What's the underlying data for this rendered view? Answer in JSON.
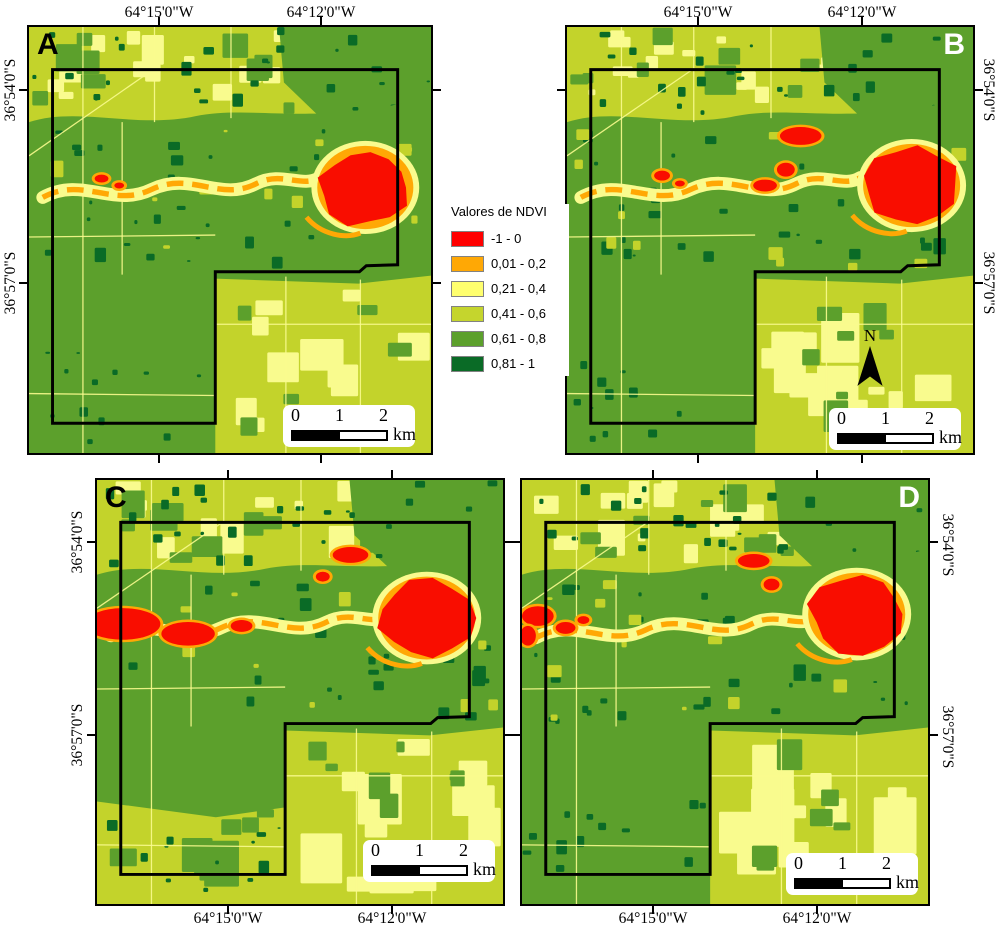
{
  "figure": {
    "type": "ndvi-classified-map-figure",
    "background": "#FFFFFF"
  },
  "legend": {
    "title": "Valores de NDVI",
    "classes": [
      {
        "label": "-1 - 0",
        "color": "#FF0000"
      },
      {
        "label": "0,01 - 0,2",
        "color": "#FFA805"
      },
      {
        "label": "0,21 - 0,4",
        "color": "#FFFF6E"
      },
      {
        "label": "0,41 - 0,6",
        "color": "#C5D52D"
      },
      {
        "label": "0,61 - 0,8",
        "color": "#5CA02C"
      },
      {
        "label": "0,81 - 1",
        "color": "#0A6B26"
      }
    ]
  },
  "axes": {
    "lon": [
      "64°15'0\"W",
      "64°12'0\"W"
    ],
    "lat": [
      "36°54'0\"S",
      "36°57'0\"S"
    ]
  },
  "panels": [
    {
      "letter": "A",
      "letter_color": "#000000",
      "letter_corner": "top-left",
      "lon_side": "top",
      "lat_side": "left",
      "north_arrow": false
    },
    {
      "letter": "B",
      "letter_color": "#FFFFFF",
      "letter_corner": "top-right",
      "lon_side": "top",
      "lat_side": "right",
      "north_arrow": true
    },
    {
      "letter": "C",
      "letter_color": "#000000",
      "letter_corner": "top-left",
      "lon_side": "bottom",
      "lat_side": "left",
      "north_arrow": false
    },
    {
      "letter": "D",
      "letter_color": "#FFFFFF",
      "letter_corner": "top-right",
      "lon_side": "bottom",
      "lat_side": "right",
      "north_arrow": false
    }
  ],
  "scalebar": {
    "ticks": [
      "0",
      "1",
      "2"
    ],
    "unit": "km"
  },
  "north_label": "N",
  "map_palette": {
    "red": "#F90D00",
    "orange": "#FFA805",
    "pale_yellow": "#F9FB8E",
    "chartreuse": "#C3D32B",
    "green": "#5CA02C",
    "dark_green": "#0A6B26",
    "boundary": "#000000"
  }
}
